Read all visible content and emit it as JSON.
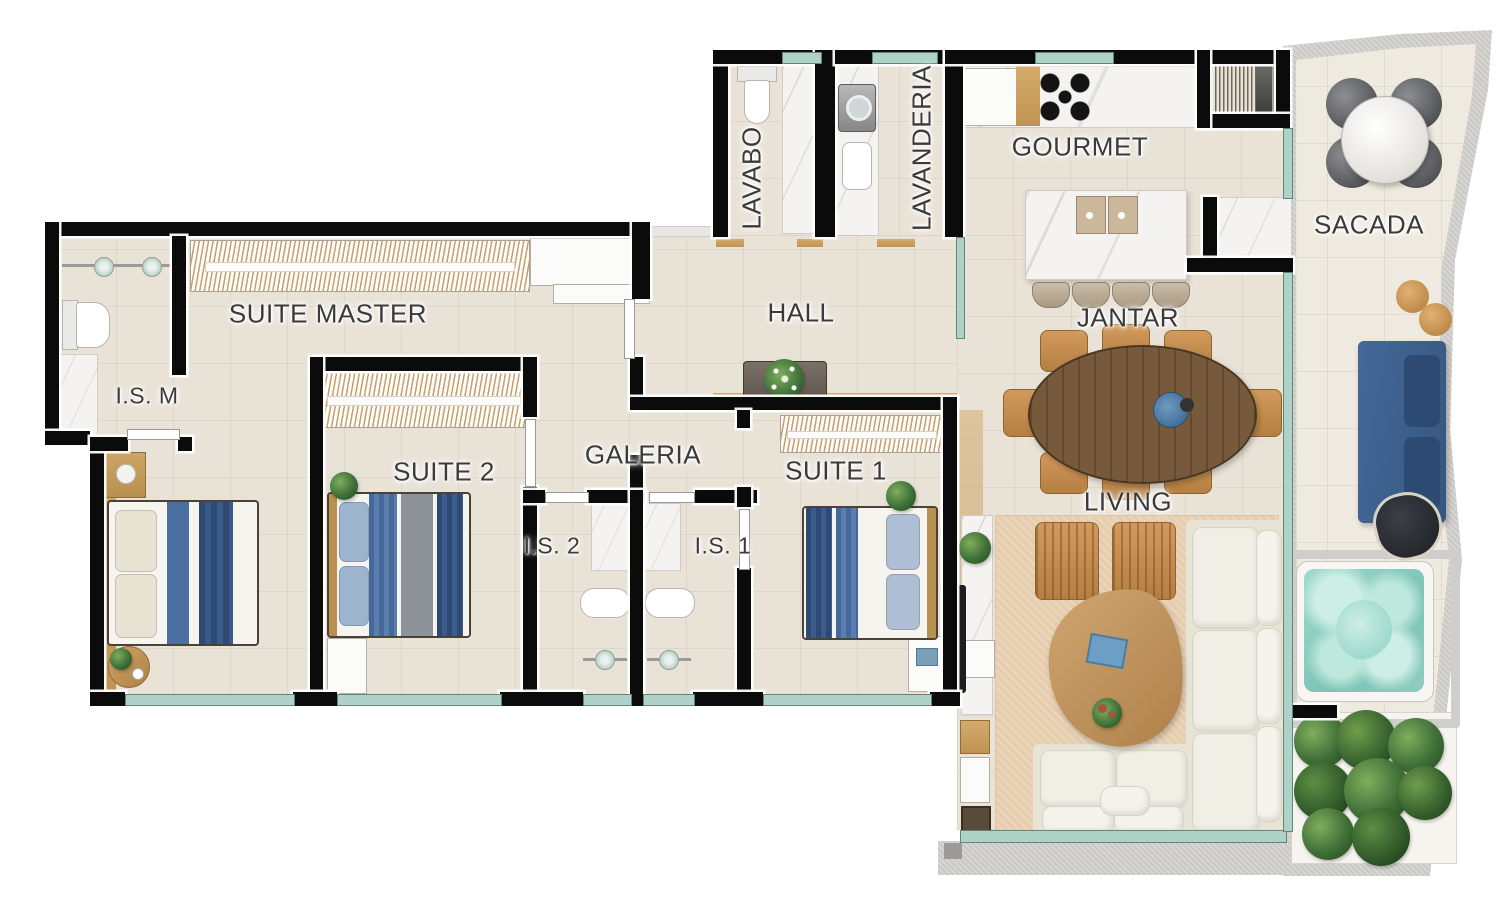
{
  "plan_type": "apartment-floor-plan",
  "rooms": {
    "suite_master": {
      "label": "SUITE MASTER"
    },
    "is_m": {
      "label": "I.S. M"
    },
    "suite_2": {
      "label": "SUITE 2"
    },
    "galeria": {
      "label": "GALERIA"
    },
    "is_2": {
      "label": "I.S. 2"
    },
    "is_1": {
      "label": "I.S. 1"
    },
    "suite_1": {
      "label": "SUITE 1"
    },
    "hall": {
      "label": "HALL"
    },
    "lavabo": {
      "label": "LAVABO"
    },
    "lavanderia": {
      "label": "LAVANDERIA"
    },
    "gourmet": {
      "label": "GOURMET"
    },
    "jantar": {
      "label": "JANTAR"
    },
    "living": {
      "label": "LIVING"
    },
    "sacada": {
      "label": "SACADA"
    }
  },
  "colors": {
    "wall": "#0b0b0b",
    "floor": "#e9e2d7",
    "balcony_floor": "#efeadf",
    "concrete": "#c9c8c4",
    "glass_window": "#aed2c8",
    "wood": "#c79e62",
    "label_text": "#3a3a3a",
    "bed_blue": "#4a6fa0",
    "bed_navy": "#2e4a74",
    "sofa_white": "#f1eee5",
    "balcony_sofa_blue": "#3d6695",
    "jacuzzi_water": "#8fccc2",
    "plant_green": "#3f7038",
    "dining_wood": "#6d5340",
    "chair_tan": "#c08a4e",
    "rug": "#ead5ba",
    "marble": "#f4f3f1"
  },
  "furniture": [
    "double-bed",
    "wardrobe",
    "nightstand",
    "toilet",
    "shower",
    "vanity-sink",
    "washing-machine",
    "refrigerator",
    "cooktop",
    "kitchen-island",
    "bar-stool",
    "dining-table",
    "dining-chair",
    "console-table",
    "l-shaped-sofa",
    "armchair",
    "coffee-table",
    "tv-panel",
    "rug",
    "outdoor-round-table",
    "outdoor-chair",
    "outdoor-stool",
    "outdoor-sofa",
    "pouf",
    "hot-tub",
    "planter-plants"
  ]
}
